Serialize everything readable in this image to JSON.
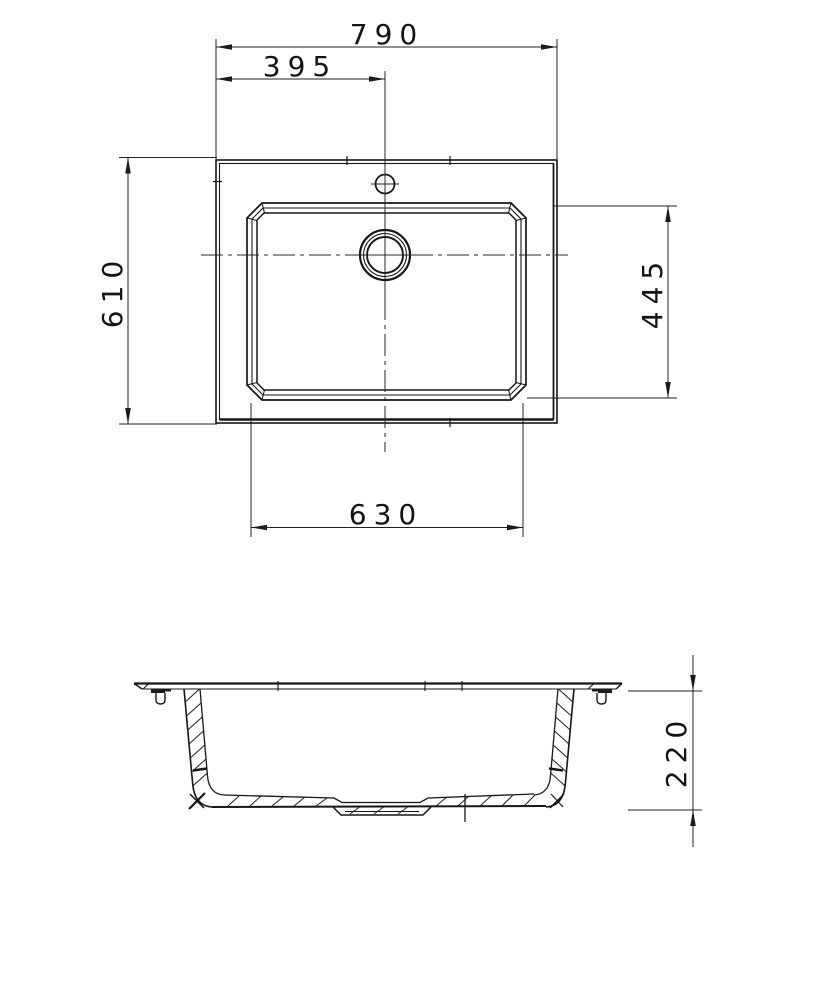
{
  "page": {
    "background": "#ffffff",
    "ink": "#161616",
    "dim_ink": "#222222"
  },
  "drawing": {
    "dims": {
      "overall_width": "790",
      "faucet_offset": "395",
      "overall_depth": "610",
      "bowl_depth": "445",
      "bowl_width": "630",
      "overall_height": "220"
    }
  }
}
